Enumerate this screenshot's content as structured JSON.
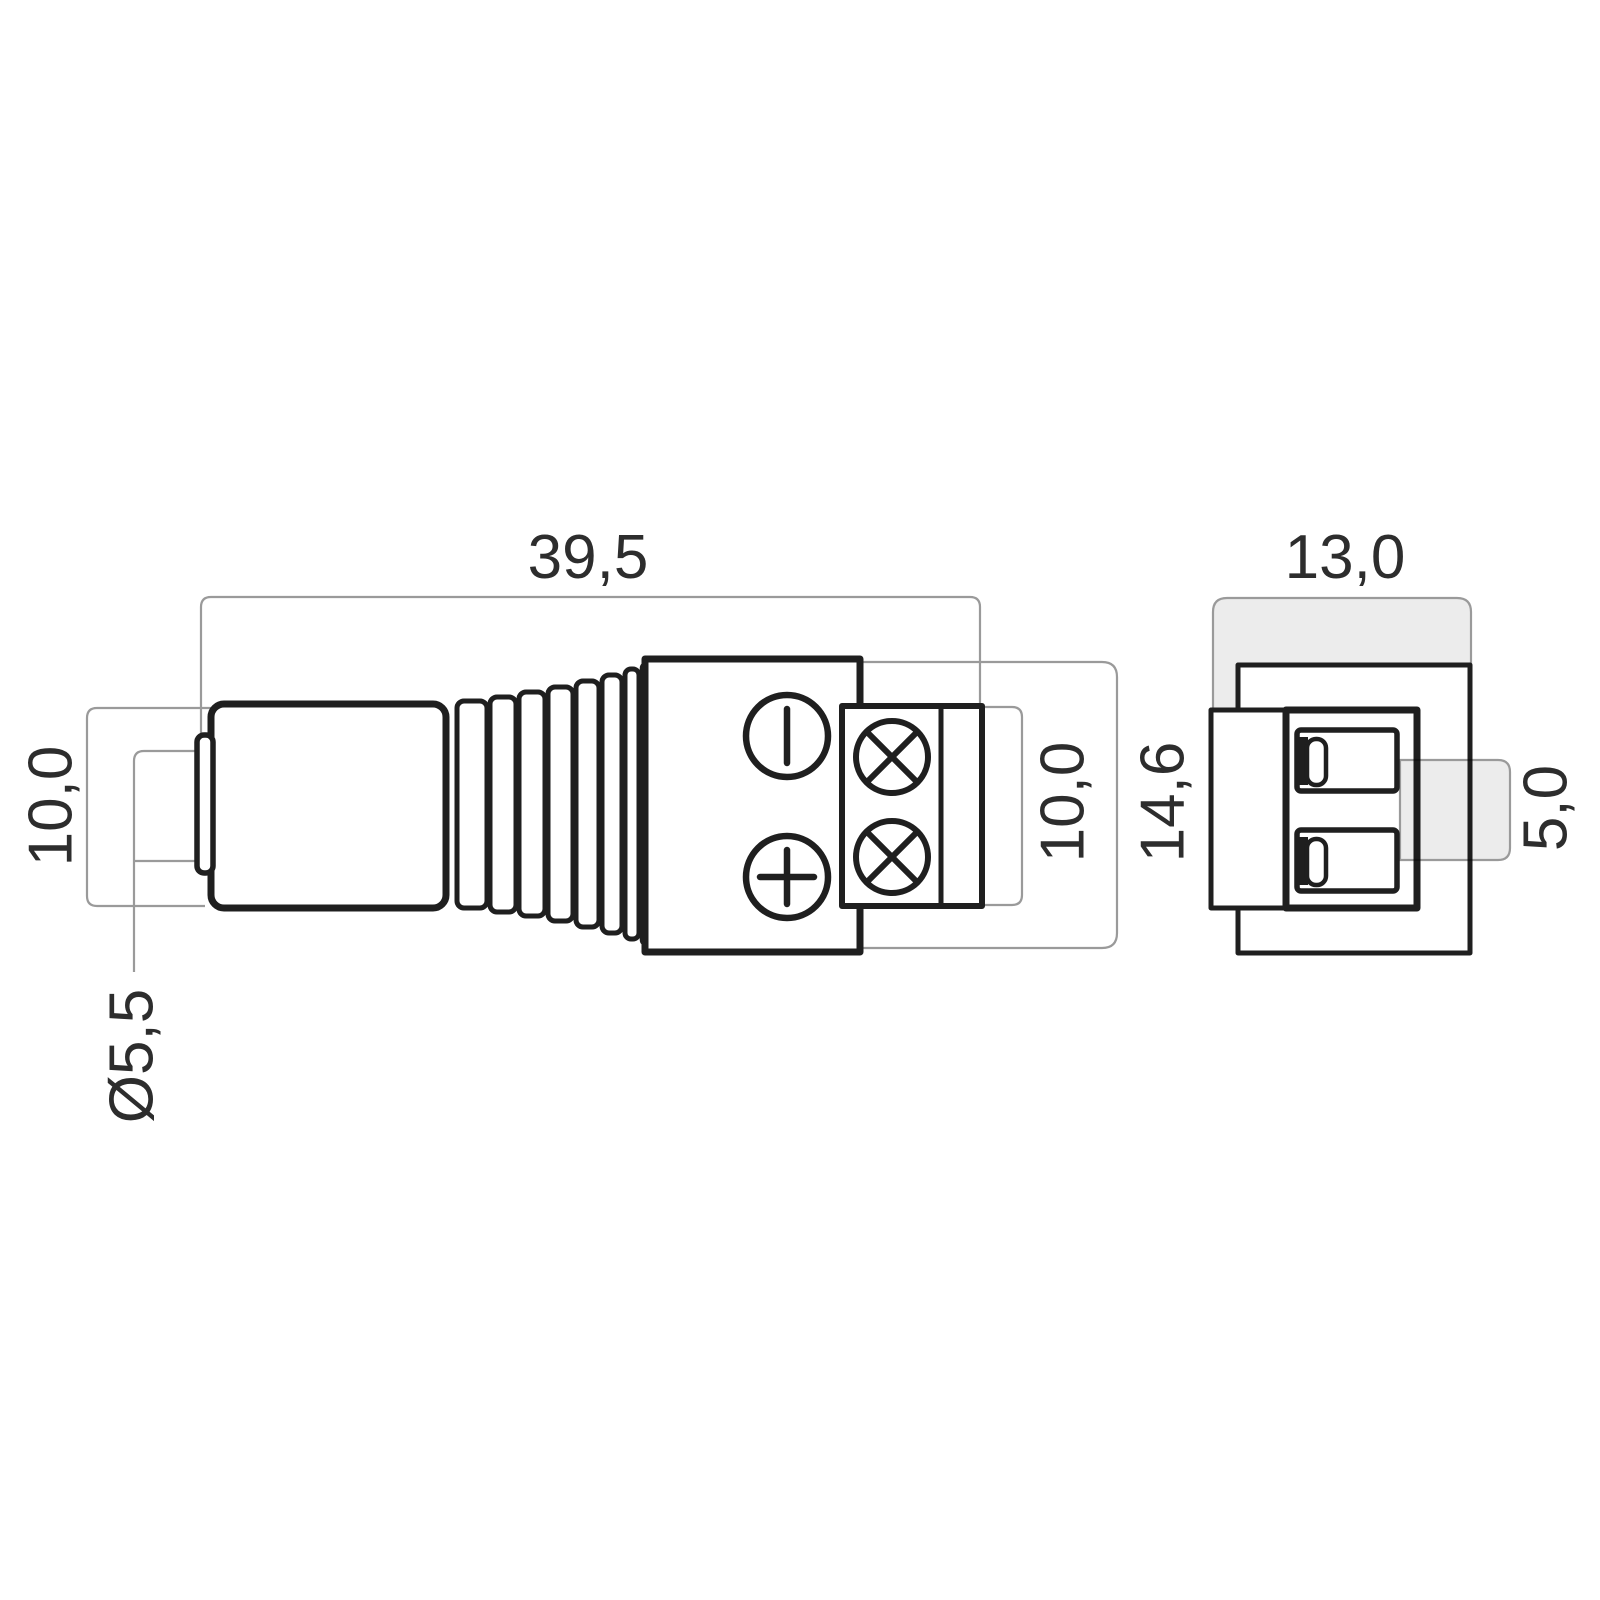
{
  "colors": {
    "background": "#ffffff",
    "outline": "#1f1f1f",
    "dimension_line": "#9a9a9a",
    "dimension_fill": "#ececec",
    "label_text": "#2d2d2d"
  },
  "side_view": {
    "labels": {
      "overall_length": "39,5",
      "plug_sleeve_height": "10,0",
      "tip_diameter": "Ø5,5",
      "terminal_block_height": "10,0",
      "housing_height": "14,6"
    }
  },
  "end_view": {
    "labels": {
      "housing_width": "13,0",
      "contact_pitch": "5,0"
    }
  },
  "icons": {
    "negative_polarity": "circle-with-vertical-slot",
    "positive_polarity": "circle-with-plus",
    "screw_terminal": "circle-with-diagonal-cross"
  }
}
